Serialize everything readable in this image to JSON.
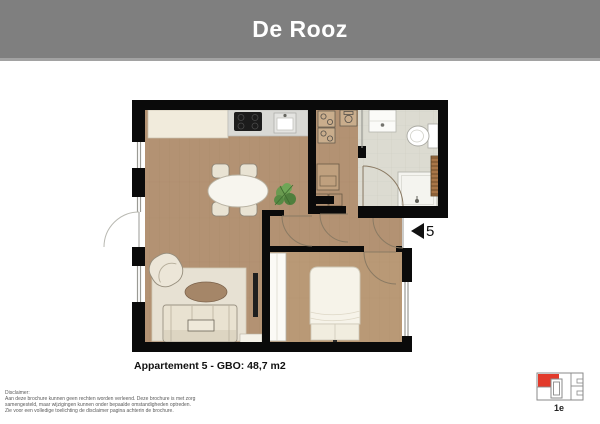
{
  "header": {
    "title": "De Rooz"
  },
  "floorplan": {
    "caption": "Appartement 5 - GBO: 48,7 m2",
    "entry_marker": "5",
    "elements": [
      "living-dining-room",
      "kitchen-counter",
      "cooktop",
      "sink",
      "dining-table",
      "plant",
      "technical-room",
      "washer",
      "dryer",
      "boiler",
      "bathroom",
      "vanity",
      "toilet",
      "shower",
      "radiator",
      "hallway",
      "bedroom",
      "wardrobe",
      "bed",
      "tv",
      "rug",
      "sofa",
      "coffee-table",
      "lounge-chair",
      "entry-door",
      "french-balcony-door",
      "windows"
    ]
  },
  "legend": {
    "floor_label": "1e"
  },
  "disclaimer": {
    "title": "Disclaimer:",
    "lines": [
      "Aan deze brochure kunnen geen rechten worden verleend. Deze brochure is met zorg",
      "samengesteld, maar wijzigingen kunnen onder bepaalde omstandigheden optreden.",
      "Zie voor een volledige toelichting de disclaimer pagina achterin de brochure."
    ]
  },
  "colors": {
    "header_bg": "#7f7f7f",
    "wall": "#0a0a0a",
    "wood_floor": "#b39273",
    "tile_floor": "#dcdbd1",
    "rug": "#e7e1d3",
    "highlight_red": "#e23a2b"
  }
}
